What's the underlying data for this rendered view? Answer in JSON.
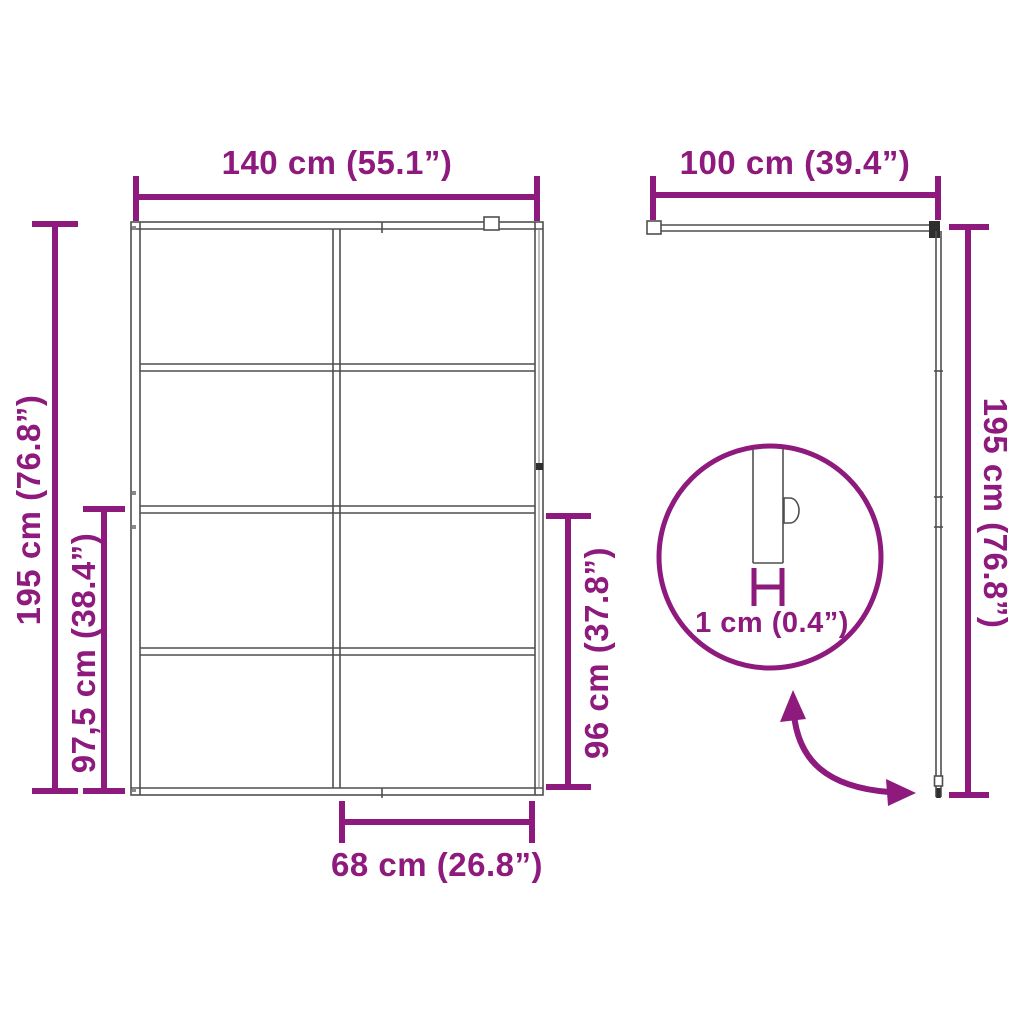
{
  "colors": {
    "accent": "#8D1A7C",
    "line": "#4f4f4f",
    "line_light": "#8a8a8a",
    "dark": "#2e2e2e",
    "background": "#ffffff"
  },
  "front_view": {
    "top_width": "140 cm (55.1”)",
    "left_height": "195 cm (76.8”)",
    "left_partial_height": "97,5 cm (38.4”)",
    "right_glass_height": "96 cm (37.8”)",
    "bottom_width": "68 cm (26.8”)"
  },
  "side_view": {
    "top_width": "100 cm (39.4”)",
    "right_height": "195 cm (76.8”)",
    "detail": {
      "thickness": "1 cm (0.4”)"
    }
  }
}
